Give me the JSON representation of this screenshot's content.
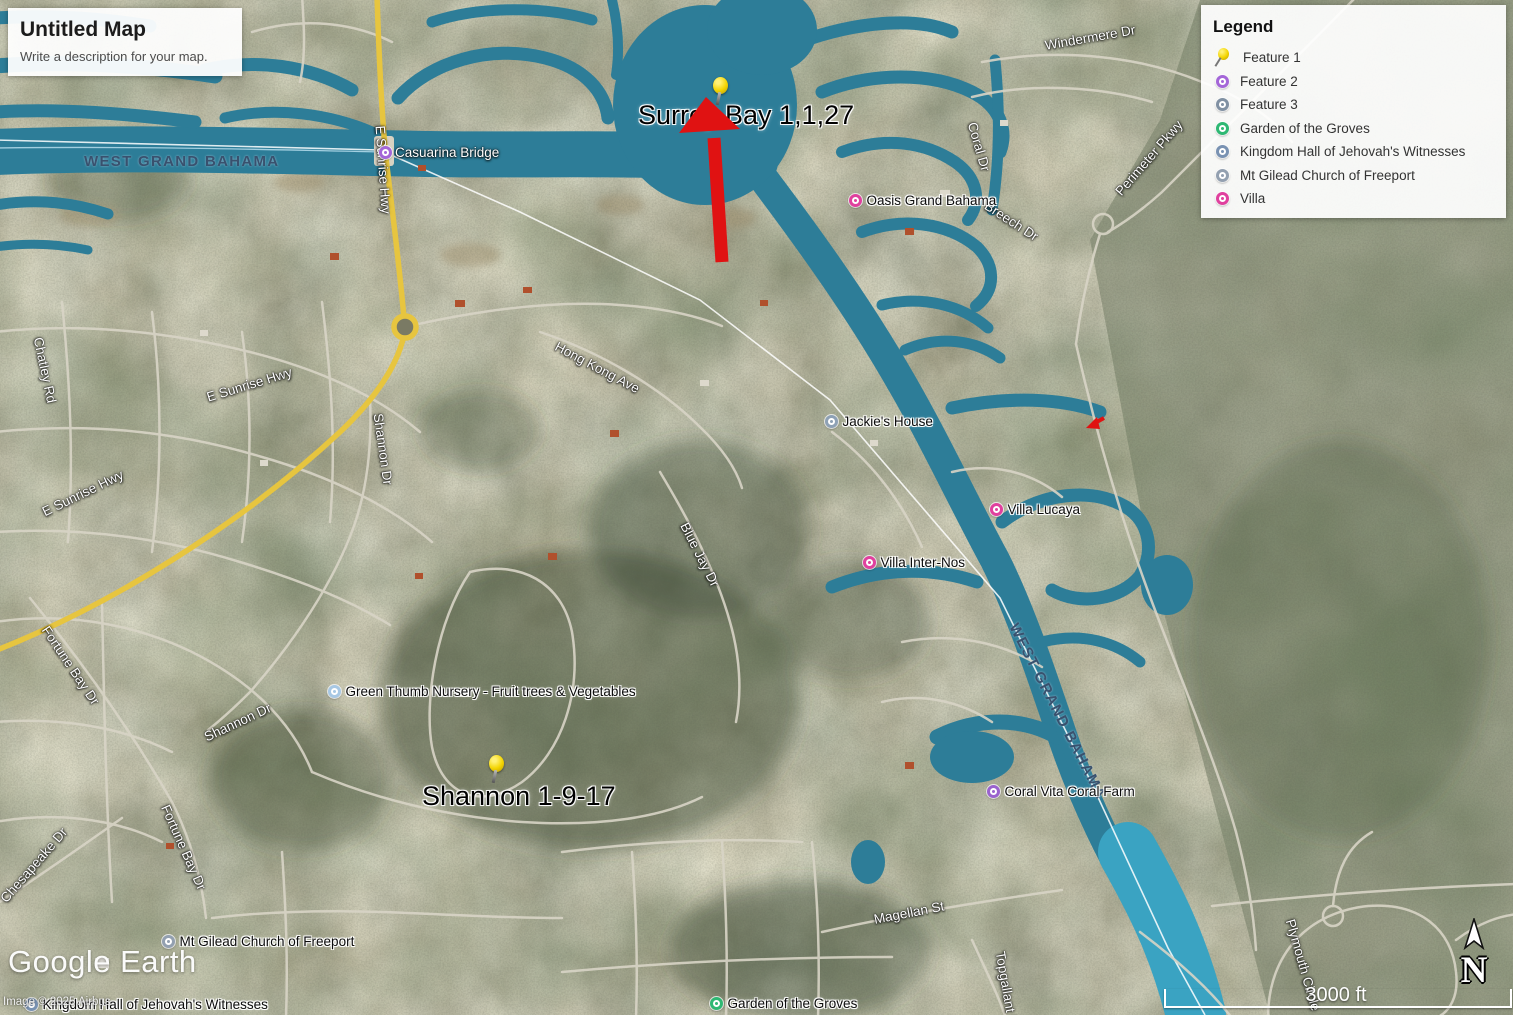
{
  "title_panel": {
    "title": "Untitled Map",
    "subtitle": "Write a description for your map."
  },
  "legend": {
    "title": "Legend",
    "items": [
      {
        "label": "Feature 1",
        "icon": "pushpin",
        "color": "#f3d400"
      },
      {
        "label": "Feature 2",
        "icon": "circle",
        "color": "#a466d8"
      },
      {
        "label": "Feature 3",
        "icon": "circle",
        "color": "#8191a3"
      },
      {
        "label": "Garden of the Groves",
        "icon": "circle",
        "color": "#2eb873"
      },
      {
        "label": "Kingdom Hall of Jehovah's Witnesses",
        "icon": "circle",
        "color": "#7992b2"
      },
      {
        "label": "Mt Gilead Church of Freeport",
        "icon": "circle",
        "color": "#93a0b0"
      },
      {
        "label": "Villa",
        "icon": "circle",
        "color": "#e0409e"
      }
    ]
  },
  "map": {
    "boundary_labels": [
      {
        "text": "WEST GRAND BAHAMA",
        "x": 84,
        "y": 153,
        "rot": 0
      },
      {
        "text": "WEST GRAND BAHAMA",
        "x": 1013,
        "y": 616,
        "rot": 63
      }
    ],
    "road_labels": [
      {
        "text": "Windermere Dr",
        "x": 1045,
        "y": 38,
        "rot": -10
      },
      {
        "text": "Casuarina Bridge",
        "x": 395,
        "y": 145,
        "rot": 0
      },
      {
        "text": "E Sunrise Hwy",
        "x": 380,
        "y": 118,
        "rot": 86
      },
      {
        "text": "Coral Dr",
        "x": 972,
        "y": 115,
        "rot": 74
      },
      {
        "text": "Perimeter Pkwy",
        "x": 1118,
        "y": 186,
        "rot": -49
      },
      {
        "text": "Breech Dr",
        "x": 986,
        "y": 197,
        "rot": 33
      },
      {
        "text": "Hong Kong Ave",
        "x": 556,
        "y": 338,
        "rot": 28
      },
      {
        "text": "Chatley Rd",
        "x": 38,
        "y": 330,
        "rot": 78
      },
      {
        "text": "Shannon Dr",
        "x": 378,
        "y": 406,
        "rot": 82
      },
      {
        "text": "E Sunrise Hwy",
        "x": 207,
        "y": 390,
        "rot": -17
      },
      {
        "text": "E Sunrise Hwy",
        "x": 43,
        "y": 505,
        "rot": -26
      },
      {
        "text": "Blue Jay Dr",
        "x": 684,
        "y": 516,
        "rot": 63
      },
      {
        "text": "Fortune Bay Dr",
        "x": 45,
        "y": 620,
        "rot": 56
      },
      {
        "text": "Shannon Dr",
        "x": 205,
        "y": 730,
        "rot": -25
      },
      {
        "text": "Fortune Bay Dr",
        "x": 165,
        "y": 798,
        "rot": 66
      },
      {
        "text": "Chesapeake Dr",
        "x": 3,
        "y": 893,
        "rot": -49
      },
      {
        "text": "Magellan St",
        "x": 874,
        "y": 912,
        "rot": -11
      },
      {
        "text": "Topgallant Rd",
        "x": 1000,
        "y": 944,
        "rot": 80
      },
      {
        "text": "Plymouth Circle",
        "x": 1290,
        "y": 912,
        "rot": 74
      }
    ],
    "poi_labels": [
      {
        "text": "",
        "mx": 385,
        "my": 152,
        "color": "#a466d8"
      },
      {
        "text": "Oasis Grand Bahama",
        "mx": 855,
        "my": 199,
        "color": "#e0409e"
      },
      {
        "text": "Jackie's House",
        "mx": 831,
        "my": 420,
        "color": "#8ea1b5"
      },
      {
        "text": "Villa Lucaya",
        "mx": 996,
        "my": 508,
        "color": "#e0409e"
      },
      {
        "text": "Villa Inter-Nos",
        "mx": 869,
        "my": 561,
        "color": "#e0409e"
      },
      {
        "text": "Green Thumb Nursery -  Fruit trees & Vegetables",
        "mx": 334,
        "my": 690,
        "color": "#a8c8e4"
      },
      {
        "text": "Coral Vita Coral Farm",
        "mx": 993,
        "my": 790,
        "color": "#9a63ce"
      },
      {
        "text": "Mt Gilead Church of Freeport",
        "mx": 168,
        "my": 940,
        "color": "#93a0b0"
      },
      {
        "text": "Kingdom Hall of Jehovah's Witnesses",
        "mx": 31,
        "my": 1003,
        "color": "#7992b2"
      },
      {
        "text": "Garden of the Groves",
        "mx": 716,
        "my": 1002,
        "color": "#2eb873"
      }
    ],
    "big_labels": [
      {
        "text": "Surrey Bay 1,1,27",
        "x": 638,
        "y": 100
      },
      {
        "text": "Shannon 1-9-17",
        "x": 422,
        "y": 781
      }
    ],
    "pins": [
      {
        "x": 706,
        "y": 76
      },
      {
        "x": 482,
        "y": 754
      }
    ]
  },
  "attribution": {
    "logo": "Google Earth",
    "copyright": "Image © 2025 Airbus"
  },
  "scale_bar": {
    "label": "3000 ft"
  },
  "compass": {
    "label": "N"
  }
}
